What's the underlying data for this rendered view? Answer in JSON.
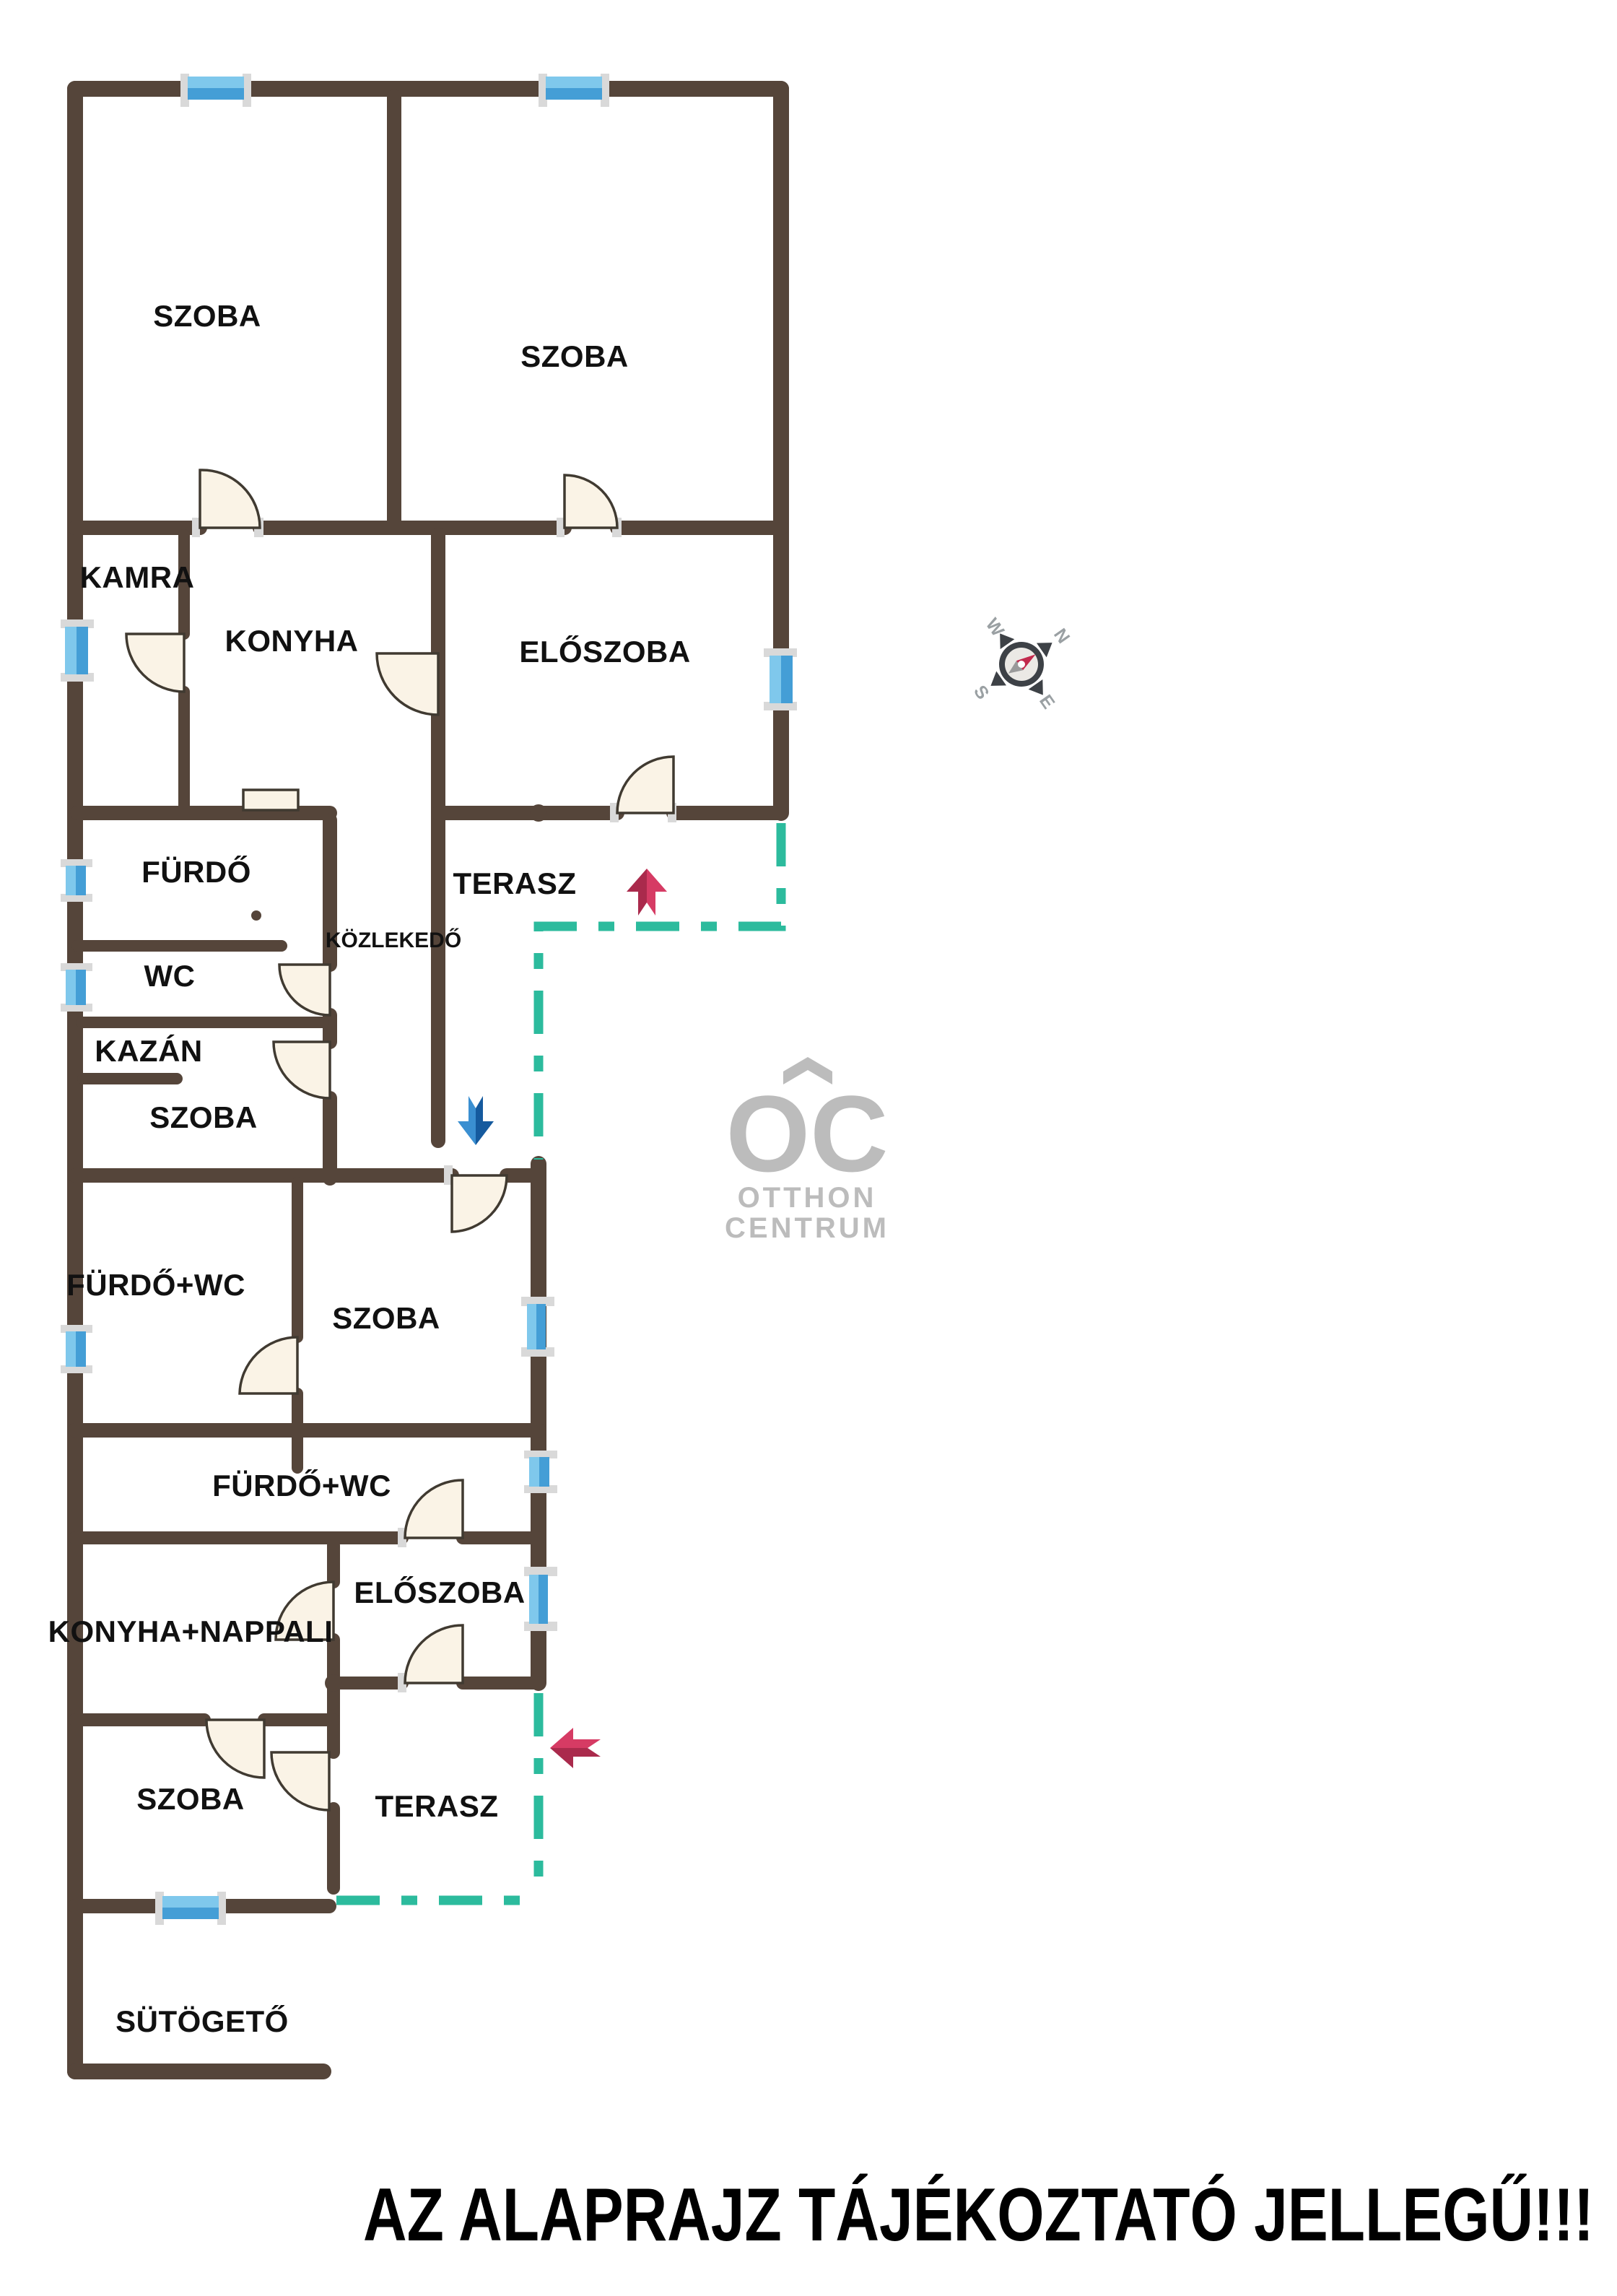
{
  "disclaimer": {
    "text": "AZ ALAPRAJZ TÁJÉKOZTATÓ JELLEGŰ!!!"
  },
  "watermark": {
    "oc": "OC",
    "line1": "OTTHON",
    "line2": "CENTRUM"
  },
  "compass": {
    "n": "N",
    "e": "E",
    "s": "S",
    "w": "W"
  },
  "rooms": [
    {
      "id": "szoba-top-left",
      "label": "SZOBA"
    },
    {
      "id": "szoba-top-right",
      "label": "SZOBA"
    },
    {
      "id": "kamra",
      "label": "KAMRA"
    },
    {
      "id": "konyha",
      "label": "KONYHA"
    },
    {
      "id": "eloszoba-upper",
      "label": "ELŐSZOBA"
    },
    {
      "id": "furdo",
      "label": "FÜRDŐ"
    },
    {
      "id": "terasz-upper",
      "label": "TERASZ"
    },
    {
      "id": "kozlekedo",
      "label": "KÖZLEKEDŐ"
    },
    {
      "id": "wc",
      "label": "WC"
    },
    {
      "id": "kazan",
      "label": "KAZÁN"
    },
    {
      "id": "szoba-kazan",
      "label": "SZOBA"
    },
    {
      "id": "furdo-wc-middle",
      "label": "FÜRDŐ+WC"
    },
    {
      "id": "szoba-middle",
      "label": "SZOBA"
    },
    {
      "id": "furdo-wc-lower",
      "label": "FÜRDŐ+WC"
    },
    {
      "id": "eloszoba-lower",
      "label": "ELŐSZOBA"
    },
    {
      "id": "konyha-nappali",
      "label": "KONYHA+NAPPALI"
    },
    {
      "id": "szoba-bottom",
      "label": "SZOBA"
    },
    {
      "id": "terasz-lower",
      "label": "TERASZ"
    },
    {
      "id": "sutogeto",
      "label": "SÜTÖGETŐ"
    }
  ],
  "colors": {
    "wall": "#55453a",
    "terrace_dash": "#2cbb9d",
    "door_fill": "#faf3e6",
    "window_light": "#7fc8ec",
    "window_dark": "#449ed6",
    "window_cap": "#d9d9d9",
    "arrow_red": "#d63b64",
    "arrow_red_dark": "#aa2a4c",
    "arrow_blue": "#3a8fd1",
    "arrow_blue_dark": "#155a9e",
    "watermark": "#bcbcbc"
  }
}
